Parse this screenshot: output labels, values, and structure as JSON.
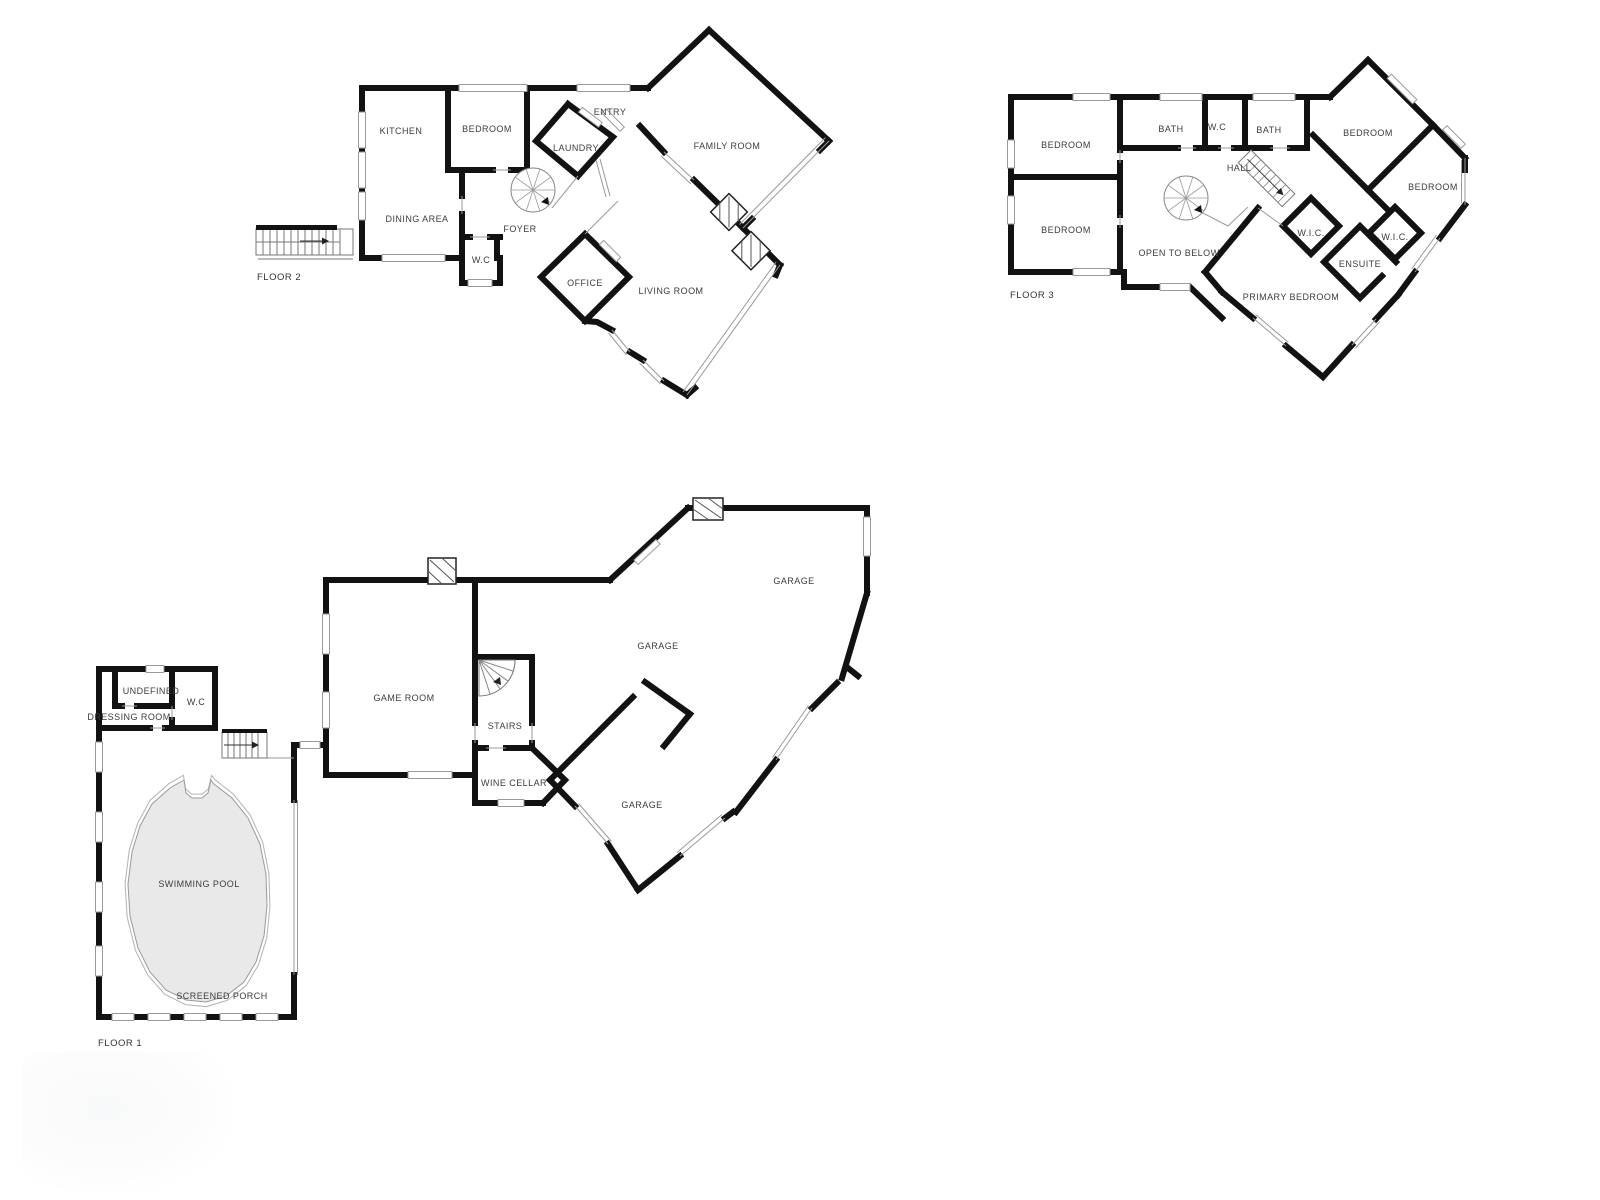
{
  "document": {
    "type": "residential floor plan set",
    "background_color": "#ffffff",
    "wall_color": "#121212",
    "label_color": "#3c3c3c",
    "pool_fill_color": "#e9e9e9"
  },
  "floors": [
    {
      "caption": "FLOOR 2",
      "rooms": [
        "KITCHEN",
        "BEDROOM",
        "ENTRY",
        "LAUNDRY",
        "FAMILY ROOM",
        "DINING AREA",
        "FOYER",
        "W.C",
        "OFFICE",
        "LIVING ROOM"
      ]
    },
    {
      "caption": "FLOOR 3",
      "rooms": [
        "BEDROOM",
        "BATH",
        "W.C",
        "BATH",
        "HALL",
        "BEDROOM",
        "BEDROOM",
        "BEDROOM",
        "OPEN TO BELOW",
        "W.I.C.",
        "W.I.C.",
        "ENSUITE",
        "PRIMARY BEDROOM"
      ]
    },
    {
      "caption": "FLOOR 1",
      "rooms": [
        "UNDEFINED",
        "W.C",
        "DRESSING ROOM",
        "GAME ROOM",
        "STAIRS",
        "WINE CELLAR",
        "GARAGE",
        "GARAGE",
        "GARAGE",
        "SWIMMING POOL",
        "SCREENED PORCH"
      ]
    }
  ]
}
